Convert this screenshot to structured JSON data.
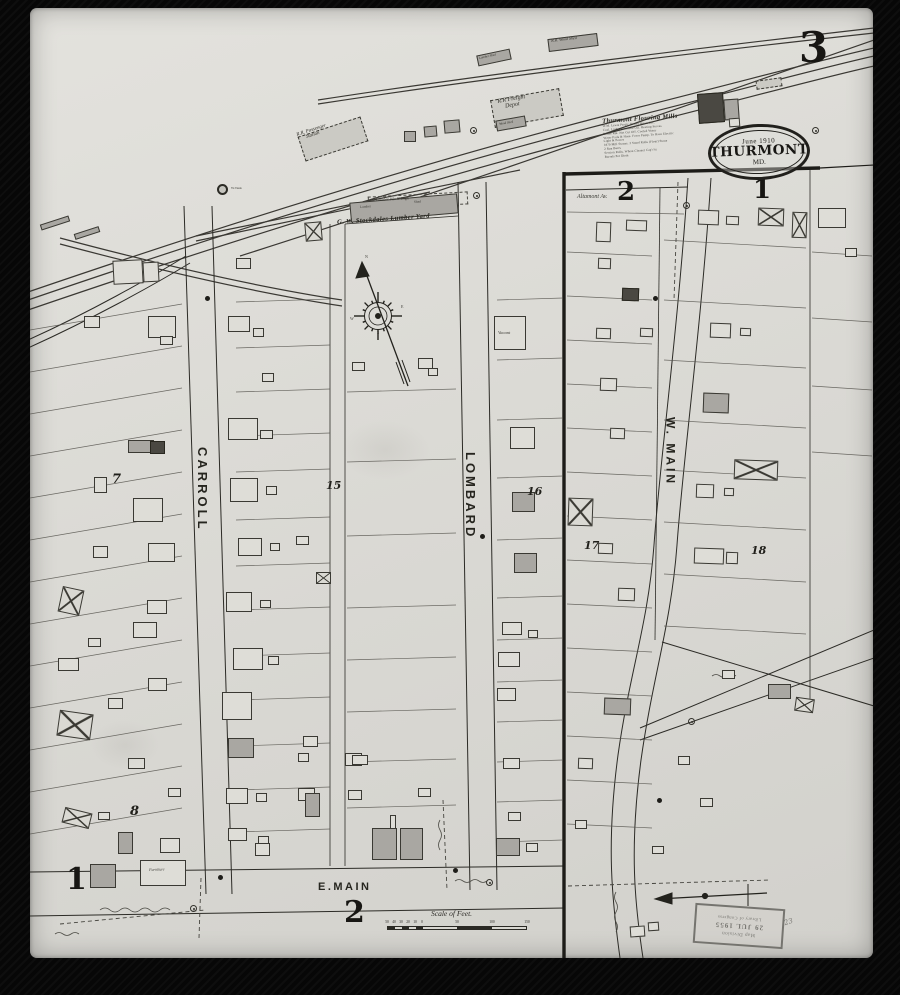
{
  "page": {
    "sheet_number": "3",
    "adjacent_sheet_top_left": "2",
    "adjacent_sheet_top_right": "1",
    "bottom_left_number": "1",
    "bottom_center_number": "2"
  },
  "town_stamp": {
    "line1": "June 1910",
    "line2": "THURMONT",
    "line3": "MD."
  },
  "library_stamp": {
    "lines": [
      "Map Division",
      "29 JUL 1955",
      "Library of Congress"
    ]
  },
  "fine_print": {
    "title": "Thurmont Flouring Mills",
    "lines": [
      "W.M. Lewis Prop'r. Power Steam Etc.",
      "Coal. Lights Kerosene Oil. Heating Stoves",
      "Boiler Rm. Not Cut Off. Cooled Water",
      "Water Pails & Hose. Force Pump. To Have Electric",
      "Light & Power",
      "1870 Mill Stones. 3 Stand Rolls (Flour) Stone",
      "2 Run Burrs",
      "Section Rolls. Wheat Cleaner Cap'c'ty",
      "Barrels Per Diem"
    ]
  },
  "scale": {
    "title": "Scale of Feet.",
    "minor_labels": [
      "50",
      "40",
      "30",
      "20",
      "10",
      "0"
    ],
    "major_labels": [
      "50",
      "100",
      "150"
    ]
  },
  "compass_letters": [
    {
      "t": "N",
      "x": 365,
      "y": 255
    },
    {
      "t": "E",
      "x": 401,
      "y": 305
    },
    {
      "t": "W",
      "x": 350,
      "y": 317
    },
    {
      "t": "S",
      "x": 377,
      "y": 331
    }
  ],
  "labels": [
    {
      "id": "sheet-number",
      "t": "3",
      "x": 799,
      "y": 26,
      "s": 42,
      "cls": "big"
    },
    {
      "id": "adjacent-sheet-2",
      "t": "2",
      "x": 617,
      "y": 179,
      "s": 26,
      "cls": "big"
    },
    {
      "id": "adjacent-sheet-1",
      "t": "1",
      "x": 753,
      "y": 177,
      "s": 26,
      "cls": "big"
    },
    {
      "id": "bottom-sheet-1",
      "t": "1",
      "x": 66,
      "y": 864,
      "s": 30,
      "cls": "big"
    },
    {
      "id": "bottom-sheet-2",
      "t": "2",
      "x": 344,
      "y": 897,
      "s": 30,
      "cls": "big"
    },
    {
      "id": "block-7",
      "t": "7",
      "x": 112,
      "y": 473,
      "s": 13,
      "cls": "block"
    },
    {
      "id": "block-8",
      "t": "8",
      "x": 130,
      "y": 805,
      "s": 13,
      "cls": "block"
    },
    {
      "id": "block-15",
      "t": "15",
      "x": 326,
      "y": 480,
      "s": 11,
      "cls": "block"
    },
    {
      "id": "block-16",
      "t": "16",
      "x": 527,
      "y": 486,
      "s": 11,
      "cls": "block"
    },
    {
      "id": "block-17",
      "t": "17",
      "x": 584,
      "y": 540,
      "s": 11,
      "cls": "block"
    },
    {
      "id": "block-18",
      "t": "18",
      "x": 751,
      "y": 545,
      "s": 11,
      "cls": "block"
    },
    {
      "id": "street-carroll",
      "t": "CARROLL",
      "x": 195,
      "y": 447,
      "s": 13,
      "cls": "street vert"
    },
    {
      "id": "street-lombard",
      "t": "LOMBARD",
      "x": 463,
      "y": 452,
      "s": 13,
      "cls": "street vert"
    },
    {
      "id": "street-w-main",
      "t": "W. MAIN",
      "x": 664,
      "y": 417,
      "s": 12,
      "cls": "street vert"
    },
    {
      "id": "street-e-main",
      "t": "E.MAIN",
      "x": 318,
      "y": 882,
      "s": 11,
      "cls": "street"
    },
    {
      "id": "street-altamont",
      "t": "Altamont Av.",
      "x": 577,
      "y": 194,
      "s": 6,
      "cls": "ital tiny"
    },
    {
      "id": "rr-passenger-station",
      "t": "R.R. Passenger\nStation",
      "x": 296,
      "y": 133,
      "s": 5,
      "rot": -18,
      "cls": "bldg-label"
    },
    {
      "id": "rr-freight-depot",
      "t": "R.R Freight\nDepot",
      "x": 497,
      "y": 99,
      "s": 6,
      "rot": -10,
      "cls": "bldg-label"
    },
    {
      "id": "rr-wood-shed",
      "t": "R.R. Wood Shed",
      "x": 551,
      "y": 39,
      "s": 4,
      "rot": -7,
      "cls": "bldg-label"
    },
    {
      "id": "lumber-shed-top",
      "t": "Lumber Shed",
      "x": 479,
      "y": 57,
      "s": 3.2,
      "rot": -12,
      "cls": "bldg-label"
    },
    {
      "id": "wood-shed",
      "t": "Wood Shed",
      "x": 499,
      "y": 123,
      "s": 3.2,
      "rot": -10,
      "cls": "bldg-label"
    },
    {
      "id": "water-tank",
      "t": "W.Tank",
      "x": 231,
      "y": 187,
      "s": 3.5,
      "cls": "tiny"
    },
    {
      "id": "lumber-pile",
      "t": "Lumber  Pile  8' High",
      "x": 376,
      "y": 198,
      "s": 4,
      "rot": -3,
      "cls": "tiny"
    },
    {
      "id": "lumber-label",
      "t": "Lumber",
      "x": 360,
      "y": 206,
      "s": 3.4,
      "rot": -4,
      "cls": "tiny"
    },
    {
      "id": "shed-label",
      "t": "Shed",
      "x": 414,
      "y": 201,
      "s": 3.4,
      "rot": -4,
      "cls": "tiny"
    },
    {
      "id": "stockdales-lumber-yard",
      "t": "G. W. Stockdales Lumber Yard",
      "x": 337,
      "y": 220,
      "s": 6.5,
      "rot": -4,
      "cls": "yard"
    },
    {
      "id": "vacant",
      "t": "Vacant",
      "x": 498,
      "y": 331,
      "s": 4.5,
      "cls": "ital tiny"
    },
    {
      "id": "furniture",
      "t": "Furniture",
      "x": 149,
      "y": 868,
      "s": 4,
      "rot": -2,
      "cls": "ital tiny"
    }
  ],
  "buildings": [
    [
      300,
      126,
      66,
      26,
      "h",
      -18
    ],
    [
      492,
      94,
      70,
      28,
      "h",
      -10
    ],
    [
      548,
      36,
      50,
      13,
      "g",
      -7
    ],
    [
      477,
      52,
      34,
      11,
      "g",
      -12
    ],
    [
      404,
      131,
      12,
      11,
      "g",
      0
    ],
    [
      424,
      126,
      13,
      11,
      "g",
      -5
    ],
    [
      444,
      120,
      16,
      13,
      "g",
      -5
    ],
    [
      496,
      118,
      30,
      11,
      "g",
      -10
    ],
    [
      698,
      93,
      26,
      30,
      "d",
      -4
    ],
    [
      724,
      99,
      15,
      21,
      "g",
      -4
    ],
    [
      729,
      118,
      11,
      9,
      "o",
      -4
    ],
    [
      756,
      79,
      26,
      9,
      "h",
      -8
    ],
    [
      818,
      208,
      28,
      20,
      "o",
      0
    ],
    [
      845,
      248,
      12,
      9,
      "o",
      0
    ],
    [
      40,
      220,
      30,
      6,
      "g",
      -18
    ],
    [
      74,
      230,
      26,
      6,
      "g",
      -18
    ],
    [
      113,
      260,
      30,
      24,
      "o",
      -3
    ],
    [
      143,
      262,
      16,
      20,
      "o",
      -3
    ],
    [
      368,
      194,
      100,
      13,
      "p",
      -3
    ],
    [
      350,
      198,
      108,
      20,
      "g",
      -5
    ],
    [
      84,
      316,
      16,
      12,
      "o",
      0
    ],
    [
      148,
      316,
      28,
      22,
      "o",
      0
    ],
    [
      160,
      336,
      13,
      9,
      "o",
      0
    ],
    [
      128,
      440,
      26,
      13,
      "g",
      0
    ],
    [
      150,
      441,
      15,
      13,
      "d",
      0
    ],
    [
      94,
      477,
      13,
      16,
      "o",
      0
    ],
    [
      133,
      498,
      30,
      24,
      "o",
      0
    ],
    [
      148,
      543,
      27,
      19,
      "o",
      0
    ],
    [
      93,
      546,
      15,
      12,
      "o",
      0
    ],
    [
      60,
      588,
      22,
      26,
      "x",
      12
    ],
    [
      147,
      600,
      20,
      14,
      "o",
      0
    ],
    [
      133,
      622,
      24,
      16,
      "o",
      0
    ],
    [
      88,
      638,
      13,
      9,
      "o",
      0
    ],
    [
      58,
      658,
      21,
      13,
      "o",
      0
    ],
    [
      148,
      678,
      19,
      13,
      "o",
      0
    ],
    [
      108,
      698,
      15,
      11,
      "o",
      0
    ],
    [
      58,
      712,
      34,
      26,
      "x",
      8
    ],
    [
      128,
      758,
      17,
      11,
      "o",
      0
    ],
    [
      168,
      788,
      13,
      9,
      "o",
      0
    ],
    [
      98,
      812,
      12,
      8,
      "o",
      0
    ],
    [
      63,
      810,
      28,
      16,
      "x",
      14
    ],
    [
      118,
      832,
      15,
      22,
      "g",
      0
    ],
    [
      160,
      838,
      20,
      15,
      "o",
      0
    ],
    [
      90,
      864,
      26,
      24,
      "g",
      0
    ],
    [
      140,
      860,
      46,
      26,
      "o",
      0
    ],
    [
      255,
      843,
      15,
      13,
      "o",
      0
    ],
    [
      228,
      316,
      22,
      16,
      "o",
      0
    ],
    [
      253,
      328,
      11,
      9,
      "o",
      0
    ],
    [
      236,
      258,
      15,
      11,
      "o",
      0
    ],
    [
      305,
      222,
      17,
      19,
      "x",
      -5
    ],
    [
      262,
      373,
      12,
      9,
      "o",
      0
    ],
    [
      228,
      418,
      30,
      22,
      "o",
      0
    ],
    [
      260,
      430,
      13,
      9,
      "o",
      0
    ],
    [
      230,
      478,
      28,
      24,
      "o",
      0
    ],
    [
      266,
      486,
      11,
      9,
      "o",
      0
    ],
    [
      238,
      538,
      24,
      18,
      "o",
      0
    ],
    [
      270,
      543,
      10,
      8,
      "o",
      0
    ],
    [
      296,
      536,
      13,
      9,
      "o",
      0
    ],
    [
      226,
      592,
      26,
      20,
      "o",
      0
    ],
    [
      260,
      600,
      11,
      8,
      "o",
      0
    ],
    [
      316,
      572,
      15,
      12,
      "x",
      0
    ],
    [
      233,
      648,
      30,
      22,
      "o",
      0
    ],
    [
      268,
      656,
      11,
      9,
      "o",
      0
    ],
    [
      222,
      692,
      30,
      28,
      "o",
      0
    ],
    [
      228,
      738,
      26,
      20,
      "g",
      0
    ],
    [
      303,
      736,
      15,
      11,
      "o",
      0
    ],
    [
      298,
      753,
      11,
      9,
      "o",
      0
    ],
    [
      226,
      788,
      22,
      16,
      "o",
      0
    ],
    [
      256,
      793,
      11,
      9,
      "o",
      0
    ],
    [
      298,
      788,
      17,
      13,
      "o",
      0
    ],
    [
      345,
      753,
      17,
      13,
      "o",
      0
    ],
    [
      228,
      828,
      19,
      13,
      "o",
      0
    ],
    [
      258,
      836,
      11,
      8,
      "o",
      0
    ],
    [
      305,
      793,
      15,
      24,
      "g",
      0
    ],
    [
      352,
      362,
      13,
      9,
      "o",
      0
    ],
    [
      418,
      358,
      15,
      11,
      "o",
      0
    ],
    [
      428,
      368,
      10,
      8,
      "o",
      0
    ],
    [
      352,
      755,
      16,
      10,
      "o",
      0
    ],
    [
      418,
      788,
      13,
      9,
      "o",
      0
    ],
    [
      390,
      815,
      6,
      14,
      "o",
      0
    ],
    [
      372,
      828,
      25,
      32,
      "g",
      0
    ],
    [
      400,
      828,
      23,
      32,
      "g",
      0
    ],
    [
      348,
      790,
      14,
      10,
      "o",
      0
    ],
    [
      494,
      316,
      32,
      34,
      "o",
      0
    ],
    [
      510,
      427,
      25,
      22,
      "o",
      0
    ],
    [
      512,
      492,
      23,
      20,
      "g",
      0
    ],
    [
      514,
      553,
      23,
      20,
      "g",
      0
    ],
    [
      502,
      622,
      20,
      13,
      "o",
      0
    ],
    [
      528,
      630,
      10,
      8,
      "o",
      0
    ],
    [
      498,
      652,
      22,
      15,
      "o",
      0
    ],
    [
      497,
      688,
      19,
      13,
      "o",
      0
    ],
    [
      503,
      758,
      17,
      11,
      "o",
      0
    ],
    [
      508,
      812,
      13,
      9,
      "o",
      0
    ],
    [
      496,
      838,
      24,
      18,
      "g",
      0
    ],
    [
      526,
      843,
      12,
      9,
      "o",
      0
    ],
    [
      596,
      222,
      15,
      20,
      "o",
      2
    ],
    [
      598,
      258,
      13,
      11,
      "o",
      2
    ],
    [
      626,
      220,
      21,
      11,
      "o",
      2
    ],
    [
      622,
      288,
      17,
      13,
      "d",
      2
    ],
    [
      596,
      328,
      15,
      11,
      "o",
      2
    ],
    [
      640,
      328,
      13,
      9,
      "o",
      2
    ],
    [
      600,
      378,
      17,
      13,
      "o",
      2
    ],
    [
      610,
      428,
      15,
      11,
      "o",
      2
    ],
    [
      568,
      498,
      25,
      28,
      "x",
      2
    ],
    [
      598,
      543,
      15,
      11,
      "o",
      2
    ],
    [
      618,
      588,
      17,
      13,
      "o",
      2
    ],
    [
      604,
      698,
      27,
      17,
      "g",
      2
    ],
    [
      578,
      758,
      15,
      11,
      "o",
      2
    ],
    [
      575,
      820,
      12,
      9,
      "o",
      0
    ],
    [
      630,
      926,
      15,
      11,
      "o",
      -4
    ],
    [
      648,
      922,
      11,
      9,
      "o",
      -4
    ],
    [
      698,
      210,
      21,
      15,
      "o",
      2
    ],
    [
      726,
      216,
      13,
      9,
      "o",
      2
    ],
    [
      758,
      208,
      26,
      18,
      "x",
      2
    ],
    [
      792,
      212,
      15,
      26,
      "x",
      2
    ],
    [
      710,
      323,
      21,
      15,
      "o",
      2
    ],
    [
      740,
      328,
      11,
      8,
      "o",
      2
    ],
    [
      703,
      393,
      26,
      20,
      "g",
      2
    ],
    [
      734,
      460,
      44,
      20,
      "x",
      2
    ],
    [
      696,
      484,
      18,
      14,
      "o",
      2
    ],
    [
      724,
      488,
      10,
      8,
      "o",
      2
    ],
    [
      694,
      548,
      30,
      16,
      "o",
      2
    ],
    [
      726,
      552,
      12,
      12,
      "o",
      2
    ],
    [
      722,
      670,
      13,
      9,
      "o",
      0
    ],
    [
      768,
      684,
      23,
      15,
      "g",
      0
    ],
    [
      795,
      698,
      19,
      14,
      "x",
      8
    ],
    [
      700,
      798,
      13,
      9,
      "o",
      0
    ],
    [
      678,
      756,
      12,
      9,
      "o",
      0
    ],
    [
      652,
      846,
      12,
      8,
      "o",
      0
    ]
  ],
  "symbols": {
    "circled": [
      [
        470,
        127
      ],
      [
        473,
        192
      ],
      [
        683,
        202
      ],
      [
        190,
        905
      ],
      [
        486,
        879
      ],
      [
        812,
        127
      ],
      [
        688,
        718
      ]
    ],
    "dots": [
      [
        205,
        296
      ],
      [
        480,
        534
      ],
      [
        653,
        296
      ],
      [
        657,
        798
      ],
      [
        453,
        868
      ],
      [
        218,
        875
      ]
    ]
  },
  "pencil_note": "23"
}
